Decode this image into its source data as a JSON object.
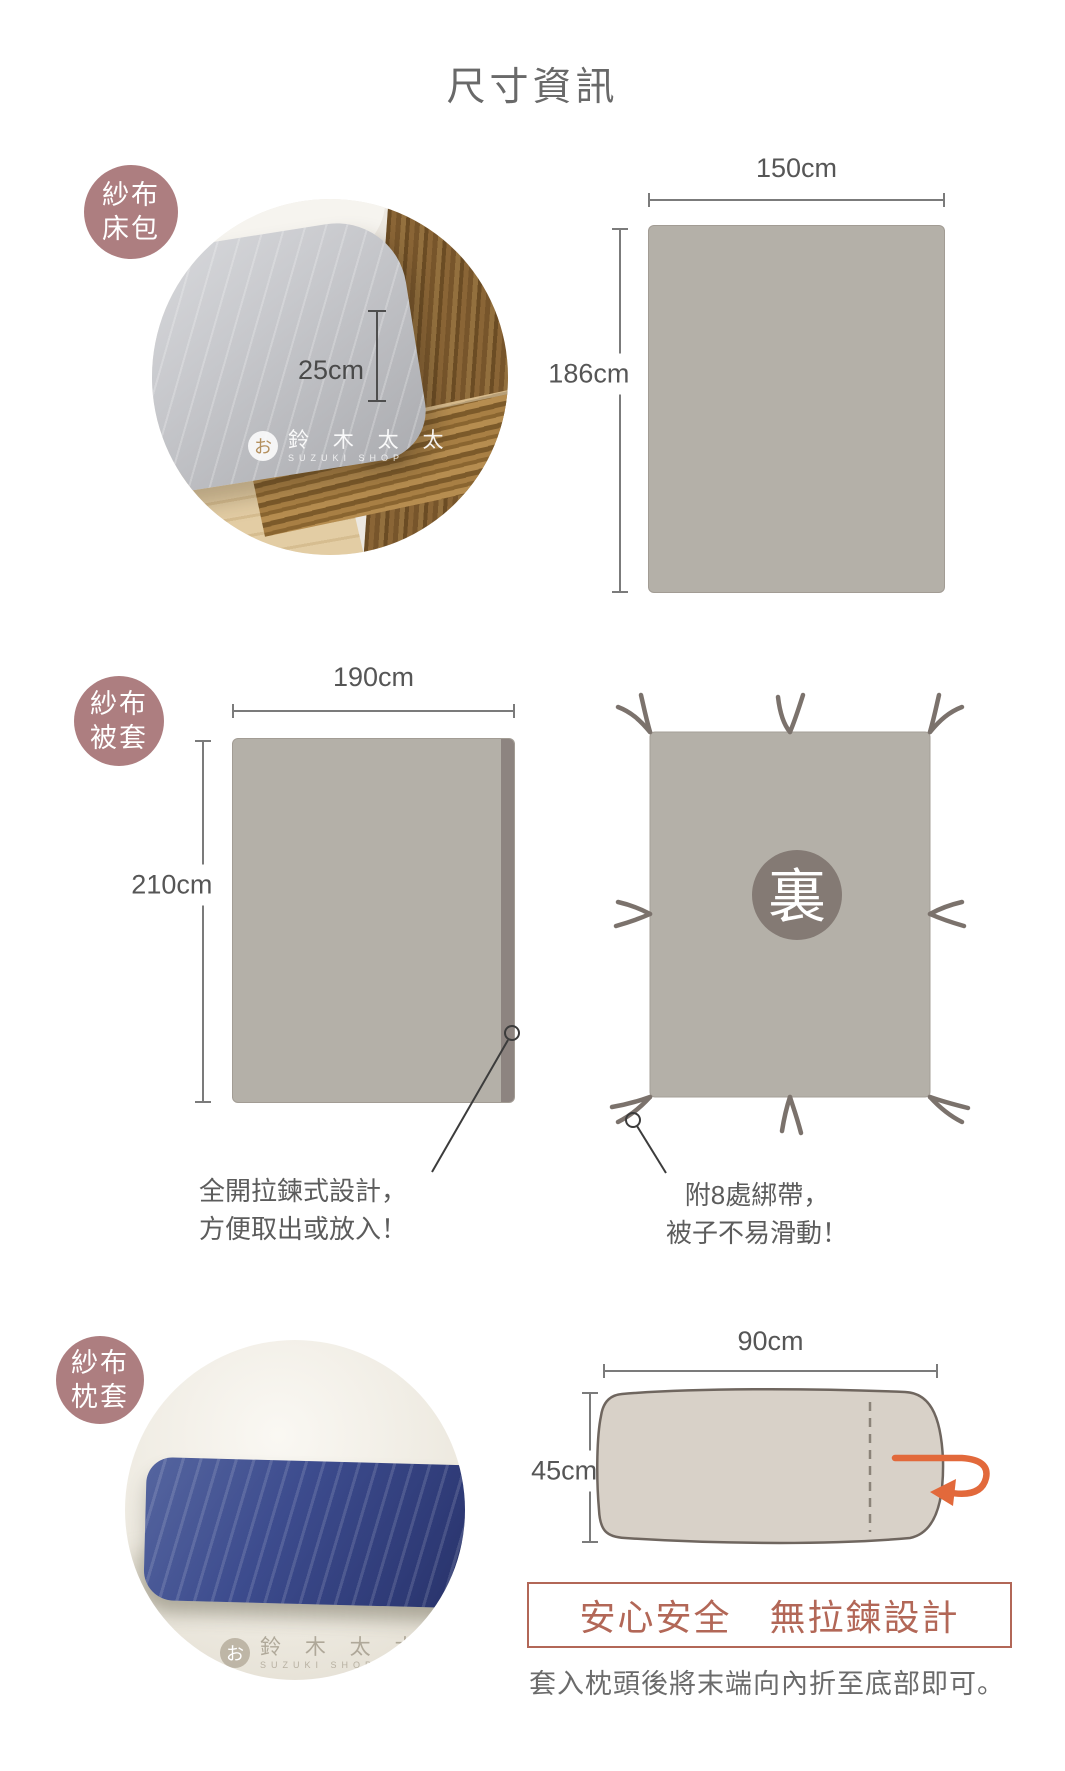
{
  "page": {
    "title": "尺寸資訊"
  },
  "colors": {
    "badge": "#ad7e80",
    "diagram_fill": "#b4b0a8",
    "zipper_strip": "#8d8480",
    "back_circle": "#847a74",
    "terracotta_accent": "#b26757",
    "arrow_orange": "#e2693b"
  },
  "watermark": {
    "logo_char": "お",
    "name": "鈴 木 太 太",
    "sub": "SUZUKI SHOP"
  },
  "sections": {
    "sheet": {
      "badge_line1": "紗布",
      "badge_line2": "床包",
      "depth_label": "25cm",
      "width_label": "150cm",
      "height_label": "186cm"
    },
    "duvet": {
      "badge_line1": "紗布",
      "badge_line2": "被套",
      "width_label": "190cm",
      "height_label": "210cm",
      "back_label": "裏",
      "zipper_note_line1": "全開拉鍊式設計，",
      "zipper_note_line2": "方便取出或放入！",
      "ties_note_line1": "附8處綁帶，",
      "ties_note_line2": "被子不易滑動！"
    },
    "pillow": {
      "badge_line1": "紗布",
      "badge_line2": "枕套",
      "width_label": "90cm",
      "height_label": "45cm",
      "safety_label": "安心安全　無拉鍊設計",
      "caption": "套入枕頭後將末端向內折至底部即可。"
    }
  }
}
